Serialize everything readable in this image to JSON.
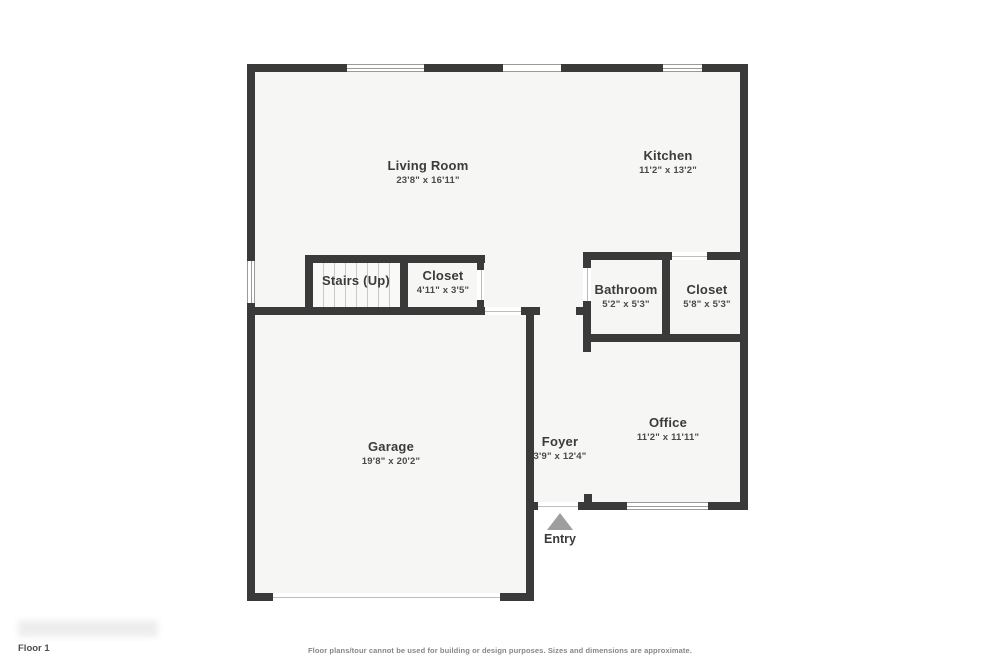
{
  "title": "Floor plan - Floor 1",
  "rooms": [
    {
      "id": "living-room",
      "name": "Living Room",
      "dims": "23'8\" x 16'11\""
    },
    {
      "id": "kitchen",
      "name": "Kitchen",
      "dims": "11'2\" x 13'2\""
    },
    {
      "id": "stairs",
      "name": "Stairs (Up)",
      "dims": ""
    },
    {
      "id": "closet-hall",
      "name": "Closet",
      "dims": "4'11\" x 3'5\""
    },
    {
      "id": "bathroom",
      "name": "Bathroom",
      "dims": "5'2\" x 5'3\""
    },
    {
      "id": "closet-bath",
      "name": "Closet",
      "dims": "5'8\" x 5'3\""
    },
    {
      "id": "garage",
      "name": "Garage",
      "dims": "19'8\" x 20'2\""
    },
    {
      "id": "foyer",
      "name": "Foyer",
      "dims": "3'9\" x 12'4\""
    },
    {
      "id": "office",
      "name": "Office",
      "dims": "11'2\" x 11'11\""
    }
  ],
  "entry": {
    "label": "Entry"
  },
  "footer": {
    "floor_label": "Floor 1",
    "disclaimer": "Floor plans/tour cannot be used for building or design purposes. Sizes and dimensions are approximate."
  },
  "colors": {
    "wall": "#3a3a3a",
    "floor": "#f6f6f5",
    "entry_arrow": "#9e9e9e",
    "room_text": "#3b3b3b",
    "dim_text": "#4a4a4a",
    "footer_text": "#878787"
  }
}
